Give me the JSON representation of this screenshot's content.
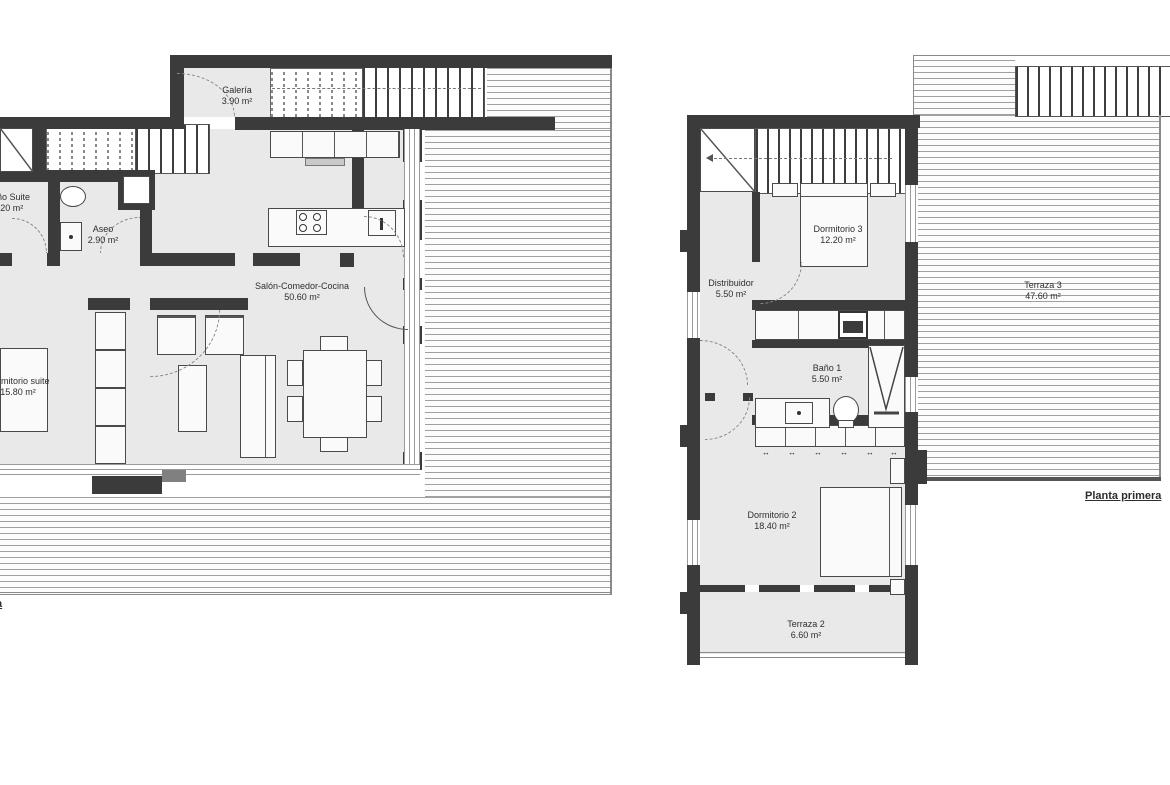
{
  "document_type": "architectural floor plan",
  "left_plan": {
    "floor_label_fragment": "a",
    "rooms": {
      "galeria": {
        "name": "Galería",
        "area": "3.90 m²"
      },
      "bano_suite": {
        "name": "Baño Suite",
        "area": "5.20 m²"
      },
      "aseo": {
        "name": "Aseo",
        "area": "2.90 m²"
      },
      "salon": {
        "name": "Salón-Comedor-Cocina",
        "area": "50.60 m²"
      },
      "dormitorio_suite": {
        "name": "Dormitorio suite",
        "area": "15.80 m²"
      }
    }
  },
  "right_plan": {
    "floor_label": "Planta primera",
    "rooms": {
      "dormitorio_3": {
        "name": "Dormitorio 3",
        "area": "12.20 m²"
      },
      "distribuidor": {
        "name": "Distribuidor",
        "area": "5.50 m²"
      },
      "bano_1": {
        "name": "Baño 1",
        "area": "5.50 m²"
      },
      "terraza_3": {
        "name": "Terraza 3",
        "area": "47.60 m²"
      },
      "dormitorio_2": {
        "name": "Dormitorio 2",
        "area": "18.40 m²"
      },
      "terraza_2": {
        "name": "Terraza 2",
        "area": "6.60 m²"
      }
    }
  },
  "symbols": {
    "wardrobe_slide_arrow": "↔"
  },
  "colors": {
    "wall": "#3b3b3b",
    "room_fill": "#e9e9e9",
    "deck_line": "#a0a0a0",
    "text": "#2e2e2e",
    "background": "#ffffff"
  }
}
